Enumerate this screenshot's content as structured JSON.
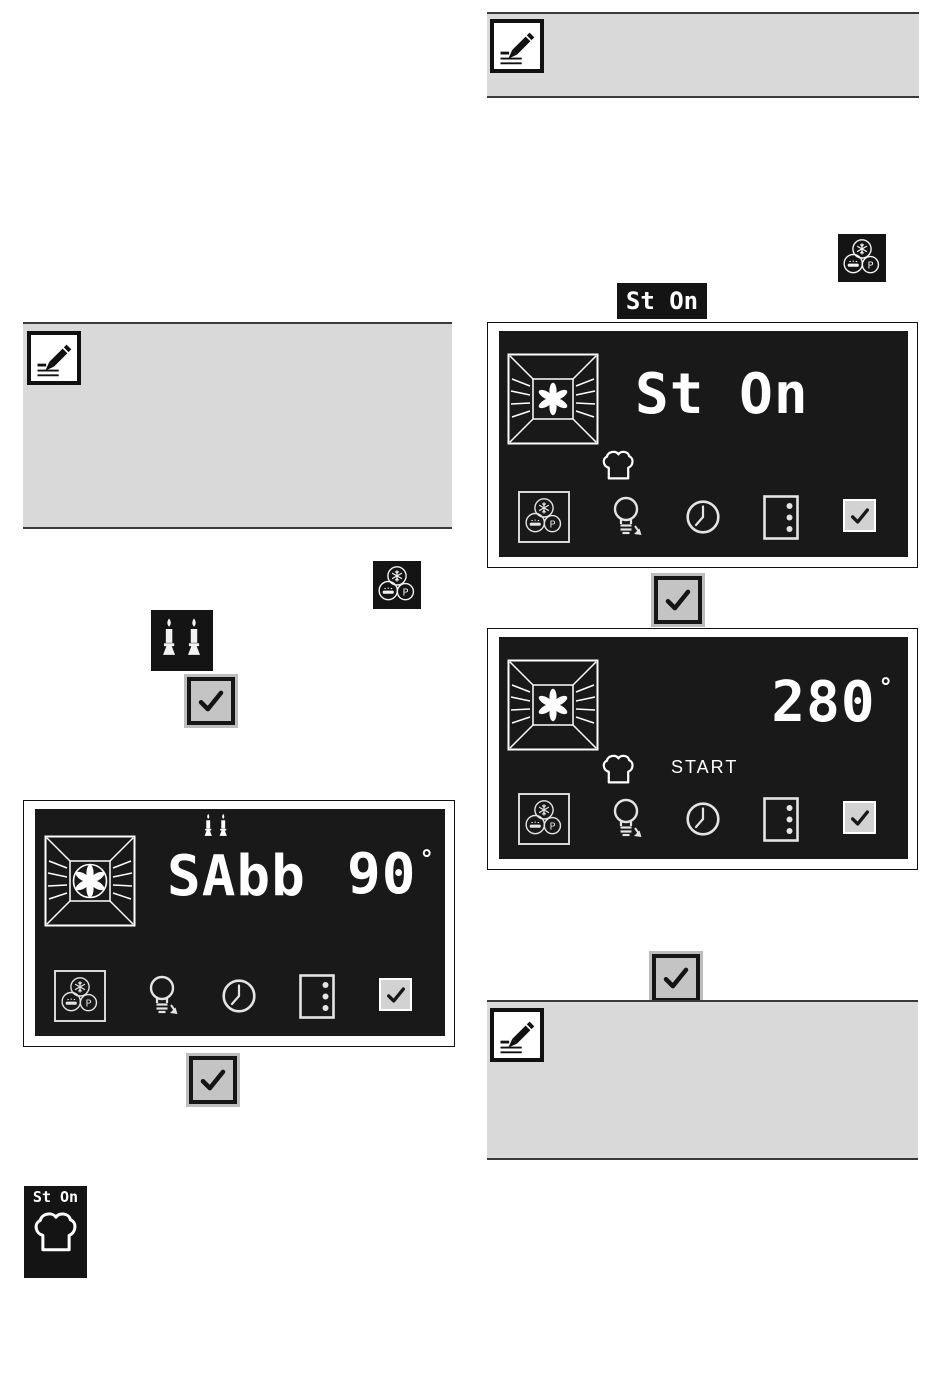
{
  "colors": {
    "page_bg": "#ffffff",
    "display_bg": "#191919",
    "display_text": "#ffffff",
    "note_bg": "#d9d9d9",
    "note_border": "#3b3b3b",
    "button_fill": "#c4c4c4",
    "button_border": "#161616",
    "check_indicator_fill": "#d2d2d2"
  },
  "icons": {
    "pencil_note": "pencil-writing-on-lines",
    "program_selection": "three-circles-snowflake-cake-P",
    "hot_air": "fan-inside-oven-cavity",
    "hot_air_circled": "fan-in-circle-inside-oven-cavity",
    "sabbath_candles": "two-lit-candles",
    "chef_hat": "chef-hat-outline",
    "oven_light": "light-bulb-with-down-arrow",
    "clock": "clock-face",
    "shelf_levels": "square-with-three-dots",
    "confirm": "checkmark"
  },
  "right_column": {
    "note_top": {
      "icon": "pencil-note-icon"
    },
    "program_button_icon": "program-selection-icon",
    "status_chip": {
      "text": "St On"
    },
    "display_sabbath_on": {
      "mode_text": "St On",
      "function_icon": "hot-air-fan-icon",
      "status_icon": "chef-hat-icon",
      "footer_icons": [
        "program-selection-icon",
        "oven-light-icon",
        "clock-icon",
        "shelf-level-icon",
        "confirm-check-icon"
      ]
    },
    "confirm_button_1": {
      "icon": "check-icon"
    },
    "display_temperature": {
      "temperature": "280",
      "degree_symbol": "°",
      "start_label": "START",
      "function_icon": "hot-air-fan-icon",
      "status_icon": "chef-hat-icon",
      "footer_icons": [
        "program-selection-icon",
        "oven-light-icon",
        "clock-icon",
        "shelf-level-icon",
        "confirm-check-icon"
      ]
    },
    "confirm_button_2": {
      "icon": "check-icon"
    },
    "note_bottom": {
      "icon": "pencil-note-icon"
    }
  },
  "left_column": {
    "note": {
      "icon": "pencil-note-icon"
    },
    "program_button_icon": "program-selection-icon",
    "sabbath_candles_icon": "sabbath-candles-icon",
    "confirm_button_1": {
      "icon": "check-icon"
    },
    "display_sabbath": {
      "mode_text": "SAbb",
      "temperature": "90",
      "degree_symbol": "°",
      "candles_icon": "sabbath-candles-icon",
      "function_icon": "hot-air-fan-circled-icon",
      "footer_icons": [
        "program-selection-icon",
        "oven-light-icon",
        "clock-icon",
        "shelf-level-icon",
        "confirm-check-icon"
      ]
    },
    "confirm_button_2": {
      "icon": "check-icon"
    },
    "sabbath_status_badge": {
      "text": "St On",
      "icon": "chef-hat-icon"
    }
  }
}
